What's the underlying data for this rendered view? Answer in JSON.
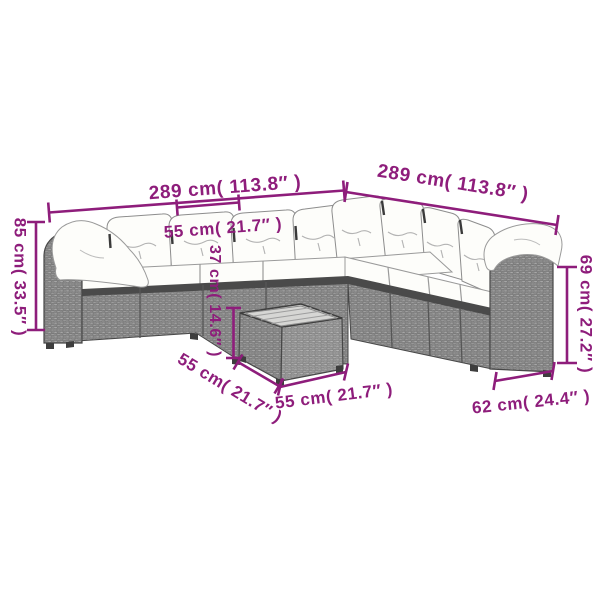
{
  "page": {
    "background": "#ffffff",
    "accent_color": "#8E1D7B"
  },
  "illustration": {
    "description": "L-shaped grey poly-rattan garden sofa set with white cushions and square coffee table",
    "colors": {
      "rattan_grey": "#8a8a8a",
      "rattan_grey_light": "#999999",
      "frame_dark": "#4a4a4a",
      "cushion_white": "#fdfdfa",
      "table_top_grey": "#d6d6d4",
      "outline": "#474747"
    }
  },
  "dimensions": {
    "sofa_total_length_left": {
      "label": "289 cm( 113.8″ )"
    },
    "sofa_total_length_right": {
      "label": "289 cm( 113.8″ )"
    },
    "sofa_back_height": {
      "label": "85 cm( 33.5″ )"
    },
    "seat_module_width": {
      "label": "55 cm( 21.7″ )"
    },
    "arm_section_height": {
      "label": "69 cm( 27.2″ )"
    },
    "table_height": {
      "label": "37 cm( 14.6″ )"
    },
    "table_depth": {
      "label": "55 cm( 21.7″ )"
    },
    "table_width": {
      "label": "55 cm( 21.7″ )"
    },
    "arm_section_depth": {
      "label": "62 cm( 24.4″ )"
    }
  }
}
